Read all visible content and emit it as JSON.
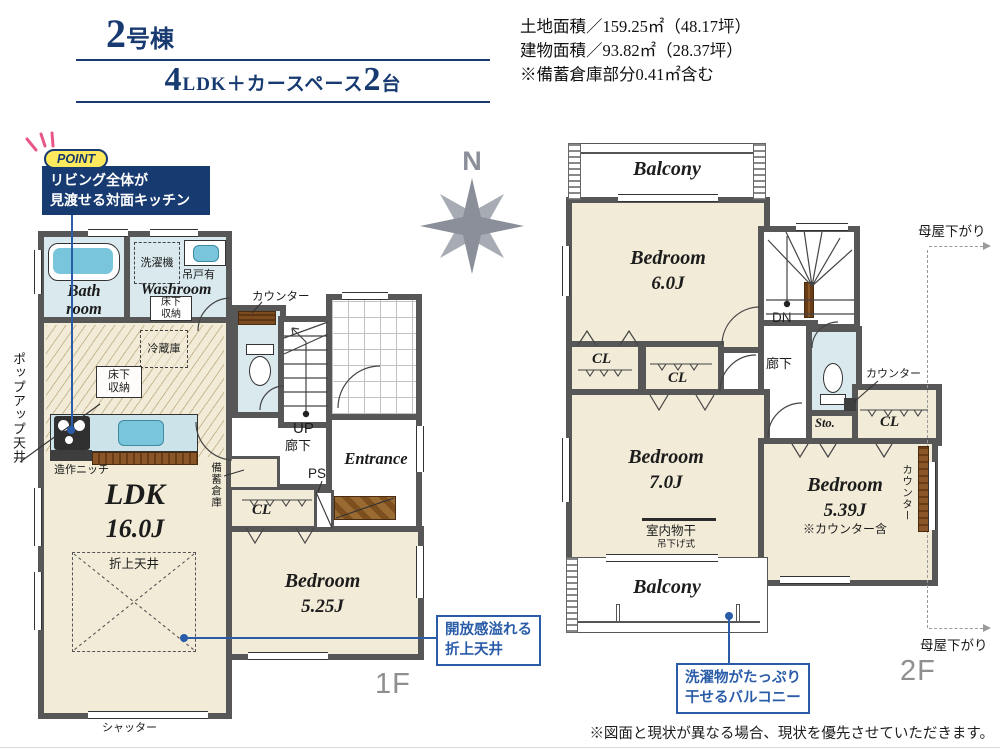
{
  "title": {
    "number": "2",
    "suffix": "号棟"
  },
  "subtitle": {
    "n1": "4",
    "mid": "LDK＋カースペース",
    "n2": "2",
    "tail": "台"
  },
  "areas": {
    "land": "土地面積／159.25㎡（48.17坪）",
    "building": "建物面積／93.82㎡（28.37坪）",
    "note": "※備蓄倉庫部分0.41㎡含む"
  },
  "point": {
    "badge": "POINT",
    "line1": "リビング全体が",
    "line2": "見渡せる対面キッチン"
  },
  "compass": {
    "n": "N"
  },
  "f1": {
    "label": "1F",
    "bath1": "Bath",
    "bath2": "room",
    "washroom": "Washroom",
    "washer": "洗濯機",
    "tsuridoari": "吊戸有",
    "yukashita1": "床下収納",
    "yukashita2": "床下収納",
    "counter": "カウンター",
    "fridge": "冷蔵庫",
    "popup": "ポップアップ天井",
    "niche": "造作ニッチ",
    "ldk": "LDK",
    "ldk_size": "16.0J",
    "oriage": "折上天井",
    "bichiku": "備蓄倉庫",
    "cl": "CL",
    "up": "UP",
    "rouka": "廊下",
    "ps": "PS",
    "entrance": "Entrance",
    "bed": "Bedroom",
    "bed_size": "5.25J",
    "shutter": "シャッター"
  },
  "f2": {
    "label": "2F",
    "balcony_top": "Balcony",
    "bed6": "Bedroom",
    "bed6_size": "6.0J",
    "dn": "DN",
    "rouka": "廊下",
    "cl_a": "CL",
    "cl_b": "CL",
    "cl_c": "CL",
    "counter": "カウンター",
    "sto": "Sto.",
    "bed7": "Bedroom",
    "bed7_size": "7.0J",
    "monohoshi": "室内物干",
    "tsurisage": "吊下げ式",
    "bed5": "Bedroom",
    "bed5_size": "5.39J",
    "counter_incl": "※カウンター含",
    "counter_v": "カウンター",
    "balcony_btm": "Balcony",
    "moya_top": "母屋下がり",
    "moya_btm": "母屋下がり"
  },
  "callouts": {
    "ceiling1": "開放感溢れる",
    "ceiling2": "折上天井",
    "laundry1": "洗濯物がたっぷり",
    "laundry2": "干せるバルコニー"
  },
  "footer": {
    "disclaimer": "※図面と現状が異なる場合、現状を優先させていただきます。"
  },
  "colors": {
    "navy": "#173a70",
    "accent": "#2a5ca8",
    "wall": "#575757",
    "cream": "#f1ebd7",
    "wet": "#d9e9ed",
    "fixture": "#79c6dc",
    "yellow": "#ffe95c",
    "graylabel": "#8f8f8f"
  }
}
